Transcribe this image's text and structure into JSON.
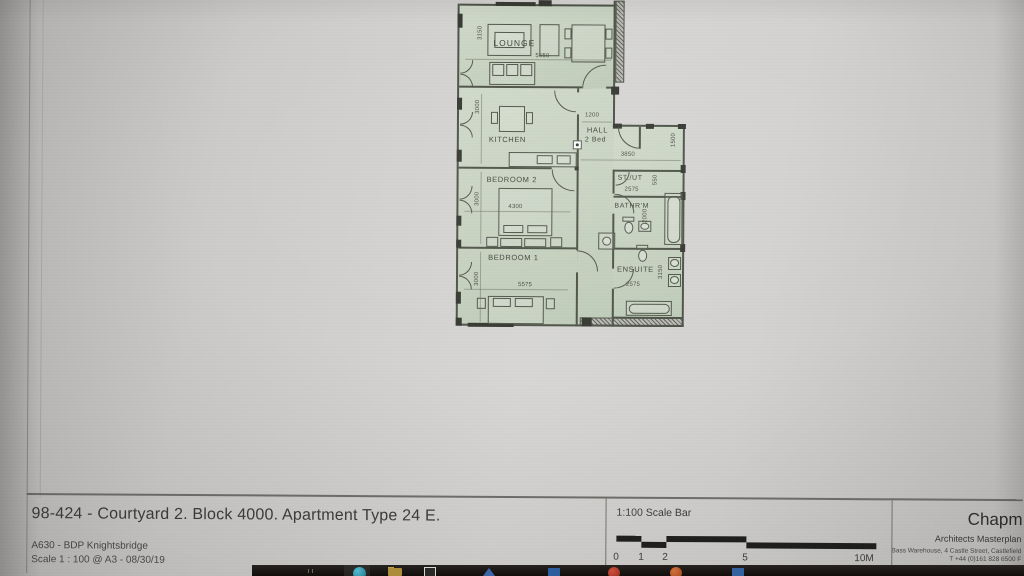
{
  "plan": {
    "labels": {
      "lounge": "LOUNGE",
      "kitchen": "KITCHEN",
      "hall": "HALL",
      "hall_sub": "2 Bed",
      "bedroom2": "BEDROOM 2",
      "stut": "ST./UT",
      "bathroom": "BATHR'M",
      "bedroom1": "BEDROOM 1",
      "ensuite": "ENSUITE"
    },
    "dimensions": {
      "lounge_width": "5650",
      "lounge_unit": "3150",
      "kitchen_depth": "3000",
      "hall_entry": "1200",
      "hall_width": "3850",
      "hall_duct": "1500",
      "stut_depth": "550",
      "bathroom_width": "2575",
      "bathroom_depth": "2000",
      "bedroom2_width": "4300",
      "bedroom2_depth": "3000",
      "bedroom1_width": "5575",
      "bedroom1_depth": "3000",
      "ensuite_width": "2575",
      "ensuite_depth": "3150"
    },
    "colors": {
      "room_fill": "#c6d2bf",
      "wall_line": "#4a5044"
    }
  },
  "title_block": {
    "drawing_title": "98-424 - Courtyard 2. Block 4000. Apartment Type 24 E.",
    "project": "A630 - BDP Knightsbridge",
    "scale_line": "Scale 1 : 100 @ A3 - 08/30/19",
    "scale_bar": {
      "label": "1:100 Scale Bar",
      "ticks": [
        "0",
        "1",
        "2",
        "5",
        "10M"
      ]
    },
    "firm": {
      "name": "Chapm",
      "dept": "Architects Masterplan",
      "address": "Bass Warehouse, 4 Castle Street, Castlefield",
      "phone": "T +44 (0)161 828 6500 F"
    }
  },
  "taskbar": {
    "icons": [
      "edge-icon",
      "file-explorer-icon",
      "window-app-icon",
      "blue-app-icon",
      "blue-square-app-icon",
      "red-app-icon",
      "orange-app-icon",
      "blue-app2-icon"
    ]
  }
}
